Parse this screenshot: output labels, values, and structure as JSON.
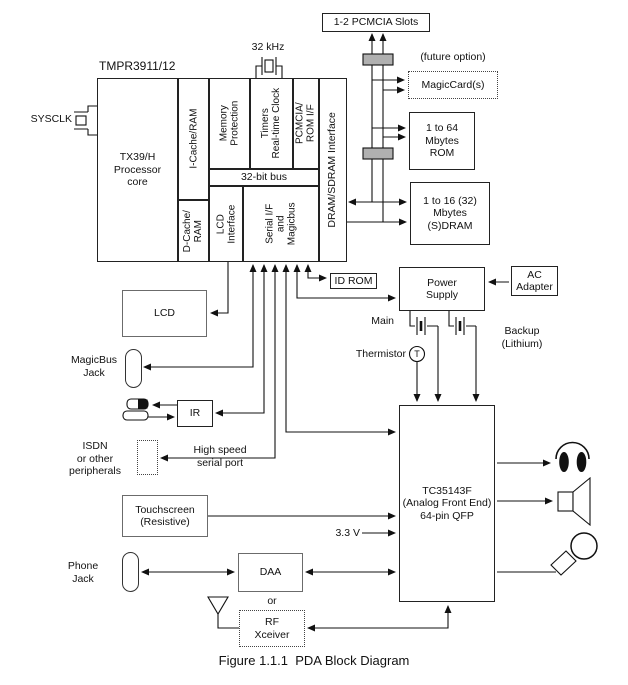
{
  "title": "TMPR3911/12",
  "caption": "Figure 1.1.1  PDA Block Diagram",
  "processor": {
    "core": "TX39/H\nProcessor\ncore",
    "icache": "I-Cache/RAM",
    "dcache": "D-Cache/\nRAM",
    "mem_prot": "Memory\nProtection",
    "timers": "Timers\nReal-time Clock",
    "pcmcia_if": "PCMCIA/\nROM I/F",
    "bus": "32-bit bus",
    "lcd_if": "LCD\nInterface",
    "serial_if": "Serial I/F\nand\nMagicbus",
    "dram_if": "DRAM/SDRAM Interface"
  },
  "blocks": {
    "pcmcia_slots": "1-2 PCMCIA Slots",
    "magiccard": "MagicCard(s)",
    "rom": "1 to 64\nMbytes\nROM",
    "sdram": "1 to 16 (32)\nMbytes\n(S)DRAM",
    "id_rom": "ID ROM",
    "power_supply": "Power\nSupply",
    "ac_adapter": "AC\nAdapter",
    "lcd": "LCD",
    "ir": "IR",
    "touchscreen": "Touchscreen\n(Resistive)",
    "daa": "DAA",
    "rf_xceiver": "RF\nXceiver",
    "tc": "TC35143F\n(Analog Front End)\n64-pin QFP"
  },
  "labels": {
    "sysclk": "SYSCLK",
    "xtal": "32 kHz",
    "future_option": "(future option)",
    "main": "Main",
    "backup": "Backup\n(Lithium)",
    "thermistor": "Thermistor",
    "thermistor_t": "T",
    "magicbus_jack": "MagicBus\nJack",
    "phone_jack": "Phone\nJack",
    "isdn": "ISDN\nor other\nperipherals",
    "high_speed": "High speed\nserial port",
    "or": "or",
    "v33": "3.3 V"
  },
  "icons": {
    "headphone-icon": "earphone output",
    "speaker-icon": "speaker output",
    "microphone-icon": "microphone input",
    "antenna-icon": "RF antenna",
    "ir-transceiver-icon": "infrared transceiver window",
    "crystal-icon": "crystal oscillator",
    "battery-icon": "battery cell",
    "connector-icon": "bus connector block",
    "thermistor-icon": "thermistor sensor"
  },
  "colors": {
    "line": "#111111",
    "connector_fill": "#b0b0b0",
    "background": "#ffffff",
    "text": "#111111"
  }
}
